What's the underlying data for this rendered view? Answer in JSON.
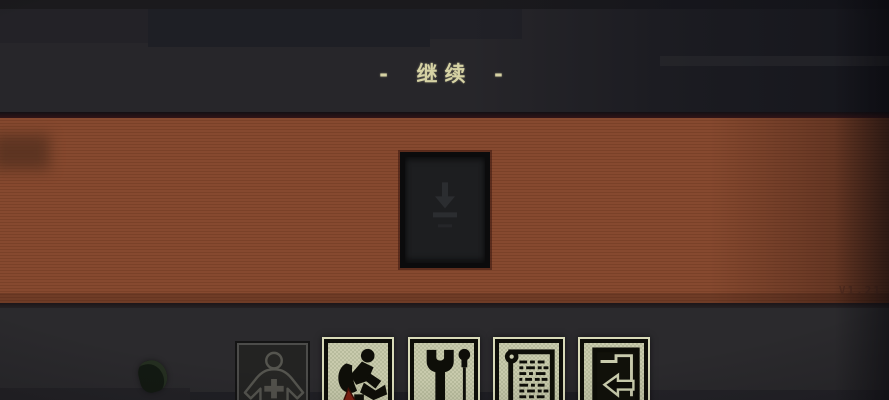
{
  "header": {
    "title": "- 继续 -"
  },
  "version_label": "V1.21",
  "save_card": {
    "icon": "download-arrow-icon",
    "state": "empty-dark"
  },
  "toolbar": {
    "buttons": [
      {
        "name": "character",
        "icon": "person-plus-icon",
        "enabled": false
      },
      {
        "name": "backpack",
        "icon": "backpack-hiker-icon",
        "enabled": true,
        "alert_marker": "red-triangle"
      },
      {
        "name": "tools",
        "icon": "wrench-screwdriver-icon",
        "enabled": true
      },
      {
        "name": "journal",
        "icon": "scroll-list-icon",
        "enabled": true
      },
      {
        "name": "exit",
        "icon": "door-arrow-icon",
        "enabled": true
      }
    ]
  },
  "colors": {
    "background_dark": "#2b2a2d",
    "top_band": "#27262a",
    "band_orange": "#81462d",
    "title_text": "#d6d2a4",
    "icon_plate": "#c4c7a9",
    "icon_glyph": "#0e0e08",
    "alert_red": "#7e2013",
    "version_text": "#4e2a1e"
  }
}
